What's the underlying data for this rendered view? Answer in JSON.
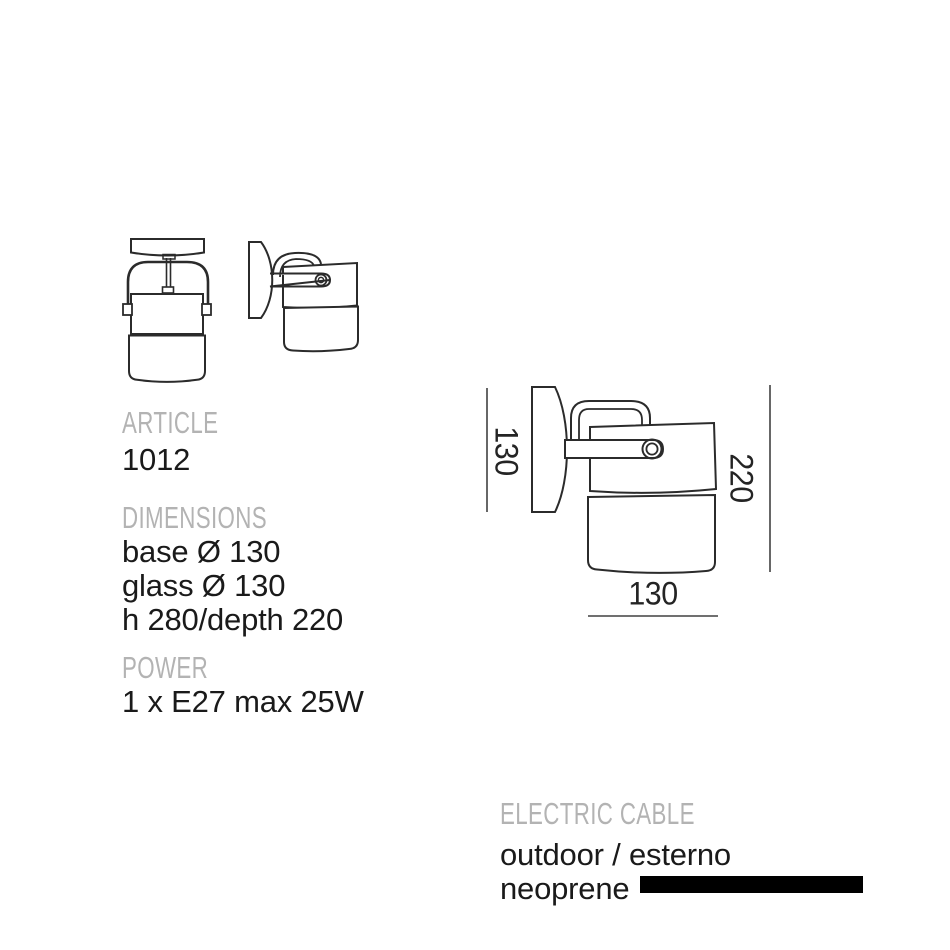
{
  "specs": {
    "article_label": "ARTICLE",
    "article_value": "1012",
    "dimensions_label": "DIMENSIONS",
    "dimension_lines": [
      "base Ø 130",
      "glass Ø 130",
      "h 280/depth 220"
    ],
    "power_label": "POWER",
    "power_value": "1 x E27 max 25W"
  },
  "cable": {
    "label": "ELECTRIC CABLE",
    "location": "outdoor / esterno",
    "material": "neoprene",
    "swatch_color": "#000000"
  },
  "diagram": {
    "plate_height": "130",
    "depth": "220",
    "body_width": "130"
  },
  "colors": {
    "heading_gray": "#b3b3b3",
    "text_black": "#1a1a1a",
    "drawing_line": "#2b2b2b"
  }
}
